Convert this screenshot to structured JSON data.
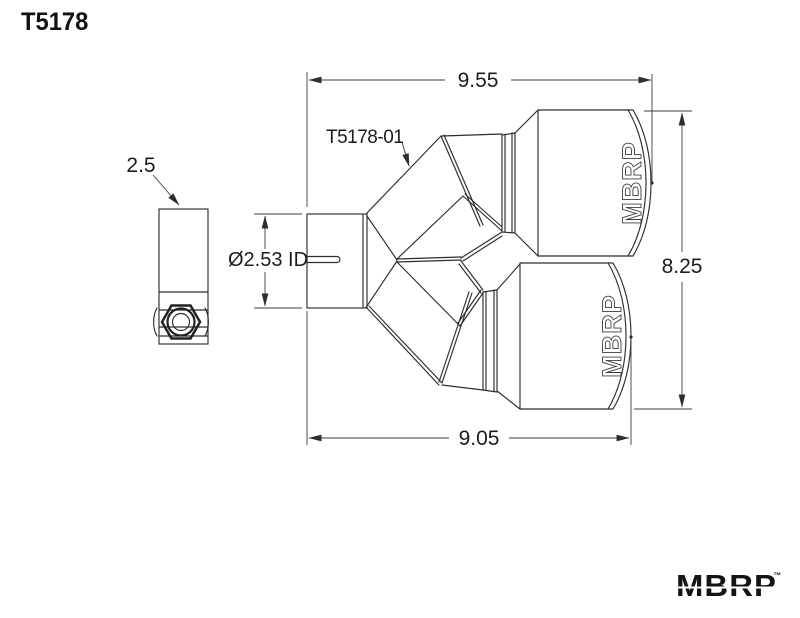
{
  "title": "T5178",
  "drawing": {
    "part_label": "T5178-01",
    "tip_brand": "MBRP",
    "dims": {
      "top_width": "9.55",
      "overall_height": "8.25",
      "bottom_width": "9.05",
      "clamp_width": "2.5",
      "inlet_id": "Ø2.53 ID"
    },
    "colors": {
      "line": "#2d2d2d",
      "background": "#ffffff"
    }
  },
  "footer": {
    "logo": "MBRP",
    "trademark": "™"
  }
}
